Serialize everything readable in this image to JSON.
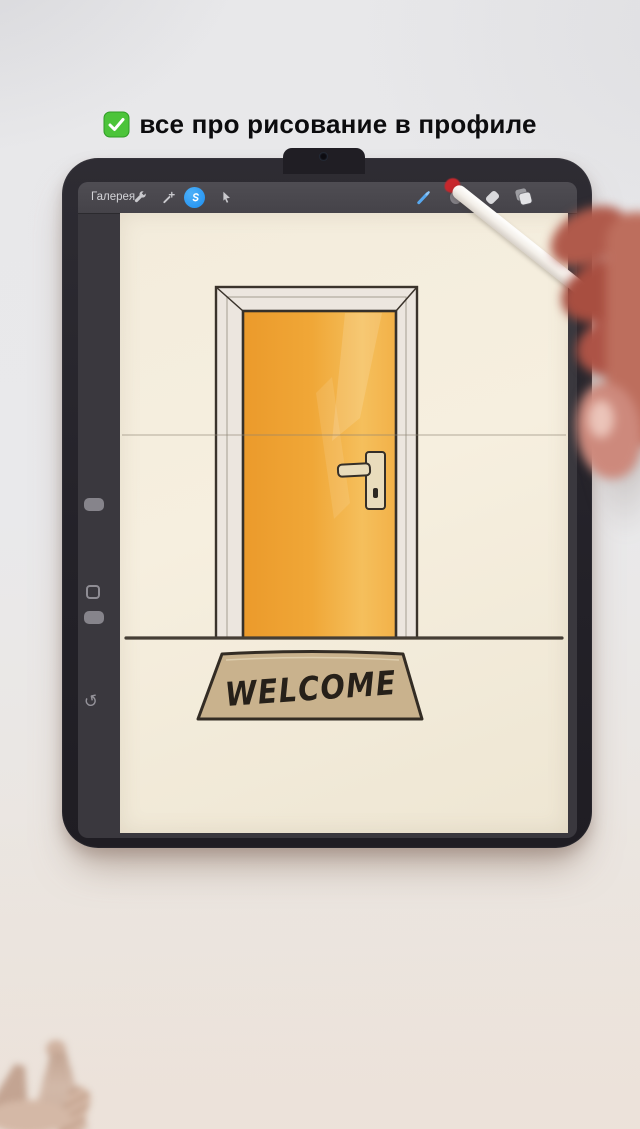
{
  "caption": {
    "emoji": "white-check-mark-emoji",
    "text": "все про рисование в профиле",
    "text_color": "#0c0c0e",
    "emoji_color": "#43b731"
  },
  "toolbar": {
    "gallery_label": "Галерея",
    "left_tools": [
      "actions-wrench-icon",
      "adjustments-wand-icon",
      "selection-icon",
      "transform-arrow-icon"
    ],
    "right_tools": [
      "paint-brush-icon",
      "smudge-icon",
      "eraser-icon",
      "layers-icon",
      "color-swatch"
    ],
    "selection_active_color": "#2b9cf2",
    "brush_active_color": "#57a8ef",
    "color_swatch_color": "#e89a43"
  },
  "sidebar": {
    "controls": [
      "brush-size-slider",
      "modify-button",
      "opacity-slider",
      "undo-button"
    ],
    "undo_glyph": "↺"
  },
  "artwork": {
    "mat_text": "WELCOME",
    "door_color": "#f0a637",
    "door_highlight": "#f5bf5c",
    "frame_color": "#ece6df",
    "mat_color": "#c9b28d",
    "paper_color": "#f4eddc",
    "outline_color": "#3a332b"
  },
  "scene": {
    "objects": [
      "ipad",
      "camera-bump",
      "apple-pencil",
      "artist-hand",
      "macrame-tassels"
    ],
    "pencil_tip_color": "#c8272c",
    "desk_color": "#e9e9eb"
  }
}
